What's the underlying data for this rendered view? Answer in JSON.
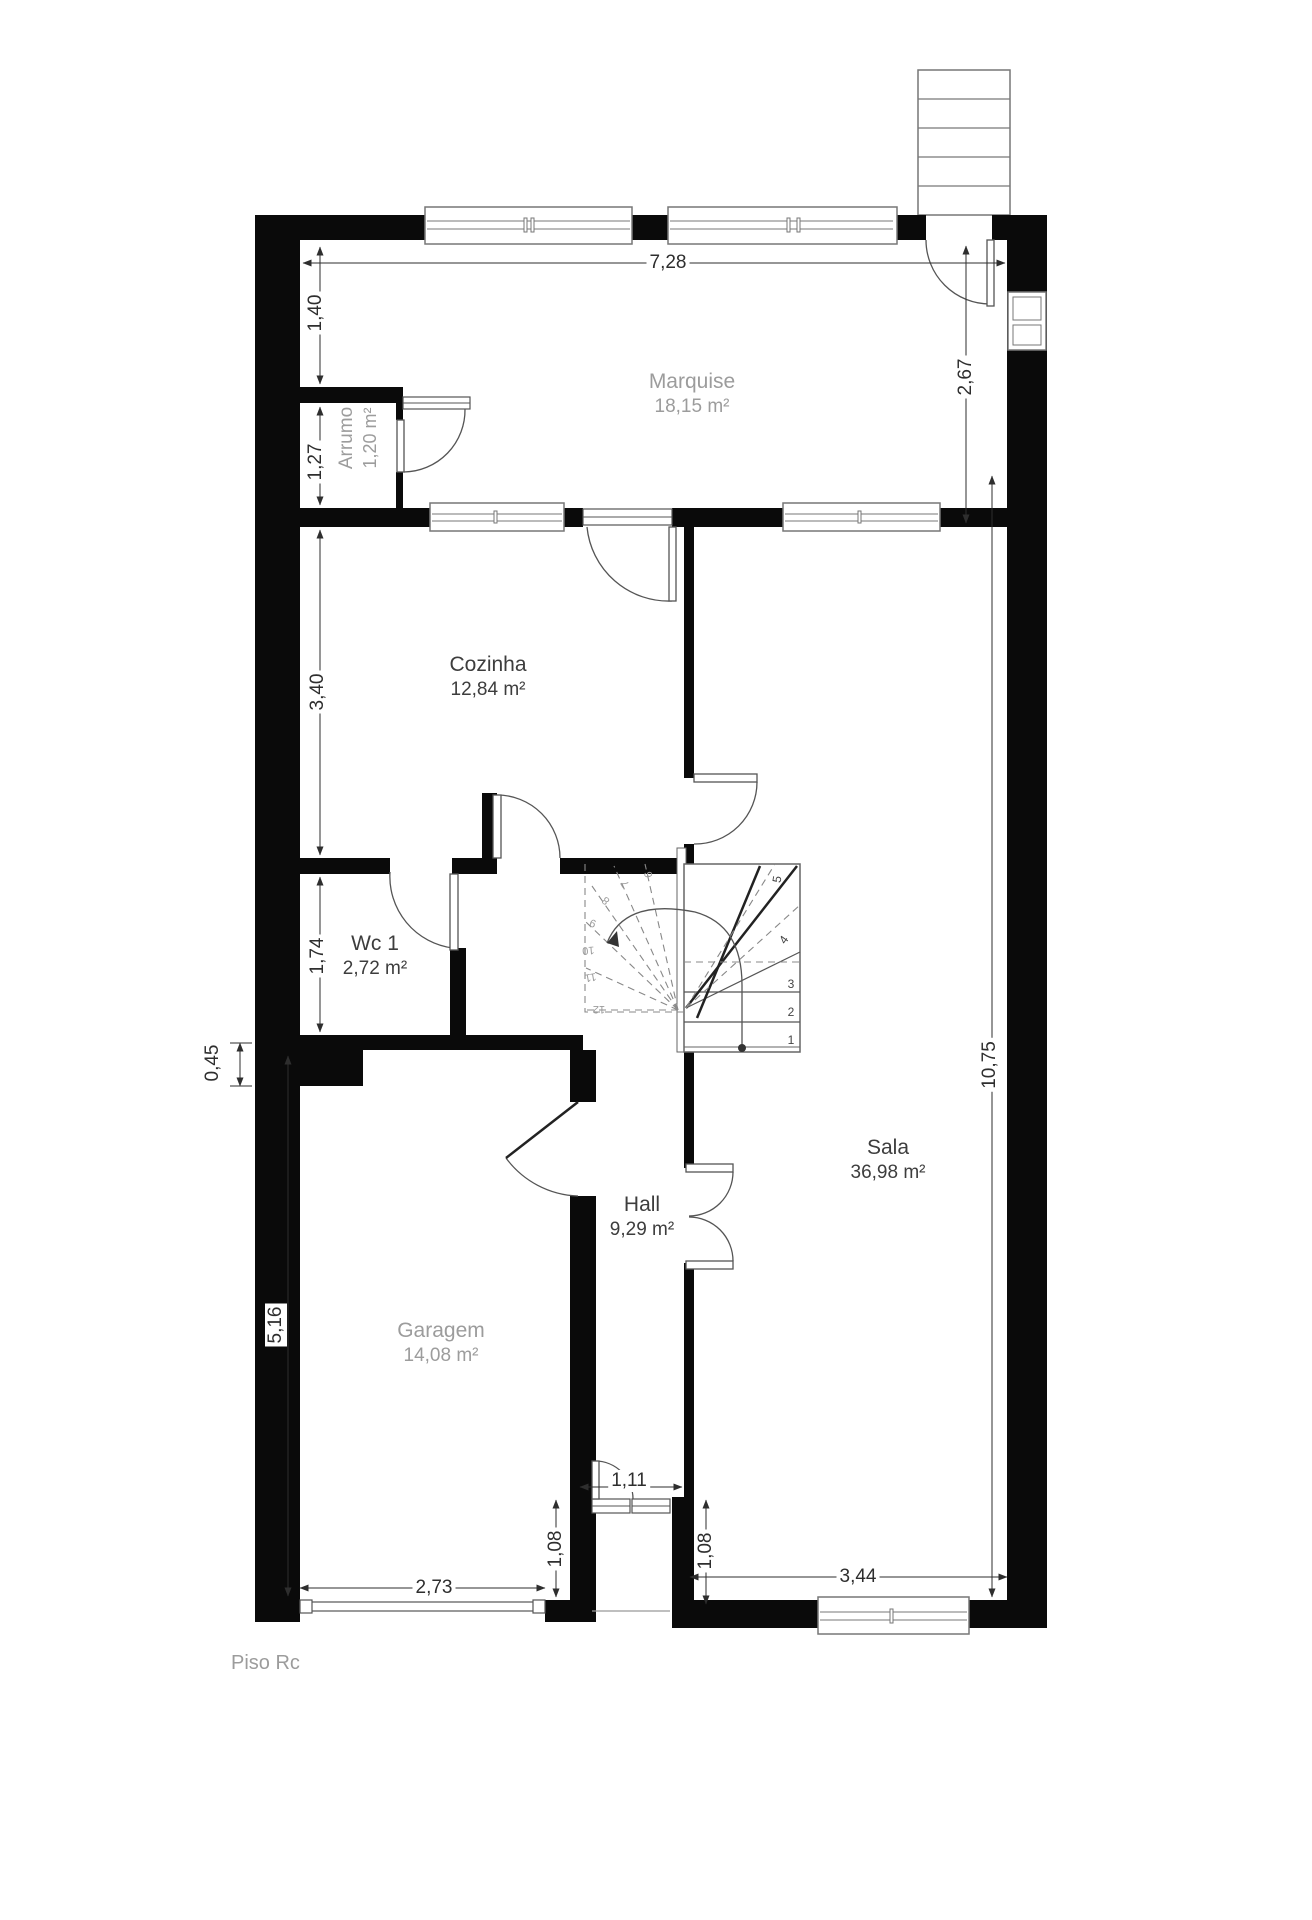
{
  "title": "Piso Rc floor plan",
  "floor_label": "Piso Rc",
  "rooms": [
    {
      "name": "Marquise",
      "area": "18,15 m²"
    },
    {
      "name": "Arrumo",
      "area": "1,20 m²"
    },
    {
      "name": "Cozinha",
      "area": "12,84 m²"
    },
    {
      "name": "Wc 1",
      "area": "2,72 m²"
    },
    {
      "name": "Hall",
      "area": "9,29 m²"
    },
    {
      "name": "Sala",
      "area": "36,98 m²"
    },
    {
      "name": "Garagem",
      "area": "14,08 m²"
    }
  ],
  "dimensions": [
    {
      "value": "7,28"
    },
    {
      "value": "1,40"
    },
    {
      "value": "1,27"
    },
    {
      "value": "2,67"
    },
    {
      "value": "3,40"
    },
    {
      "value": "1,74"
    },
    {
      "value": "0,45"
    },
    {
      "value": "5,16"
    },
    {
      "value": "10,75"
    },
    {
      "value": "2,73"
    },
    {
      "value": "1,08"
    },
    {
      "value": "1,11"
    },
    {
      "value": "1,08"
    },
    {
      "value": "3,44"
    }
  ],
  "stairs": {
    "numbers": [
      "1",
      "2",
      "3",
      "4",
      "5",
      "6",
      "7",
      "8",
      "9",
      "10",
      "11",
      "12"
    ]
  },
  "colors": {
    "wall": "#0a0a0a",
    "line": "#555555",
    "room_text": "#3d3d3d",
    "muted_text": "#9c9c9c"
  }
}
